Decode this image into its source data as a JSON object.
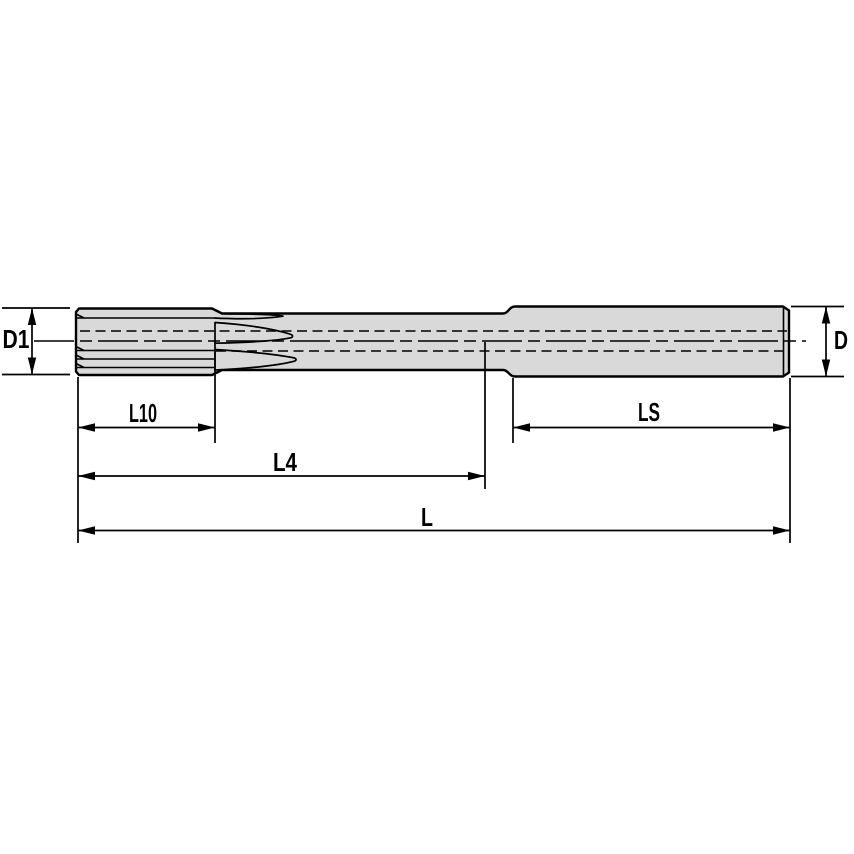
{
  "diagram": {
    "type": "technical-drawing",
    "view": "side-view-with-dimensions",
    "dimension_labels": {
      "d1": "D1",
      "d": "D",
      "l10": "L10",
      "l4": "L4",
      "ls": "LS",
      "l": "L"
    },
    "colors": {
      "body_fill": "#d9d9d9",
      "line": "#000000",
      "background": "#ffffff"
    }
  }
}
